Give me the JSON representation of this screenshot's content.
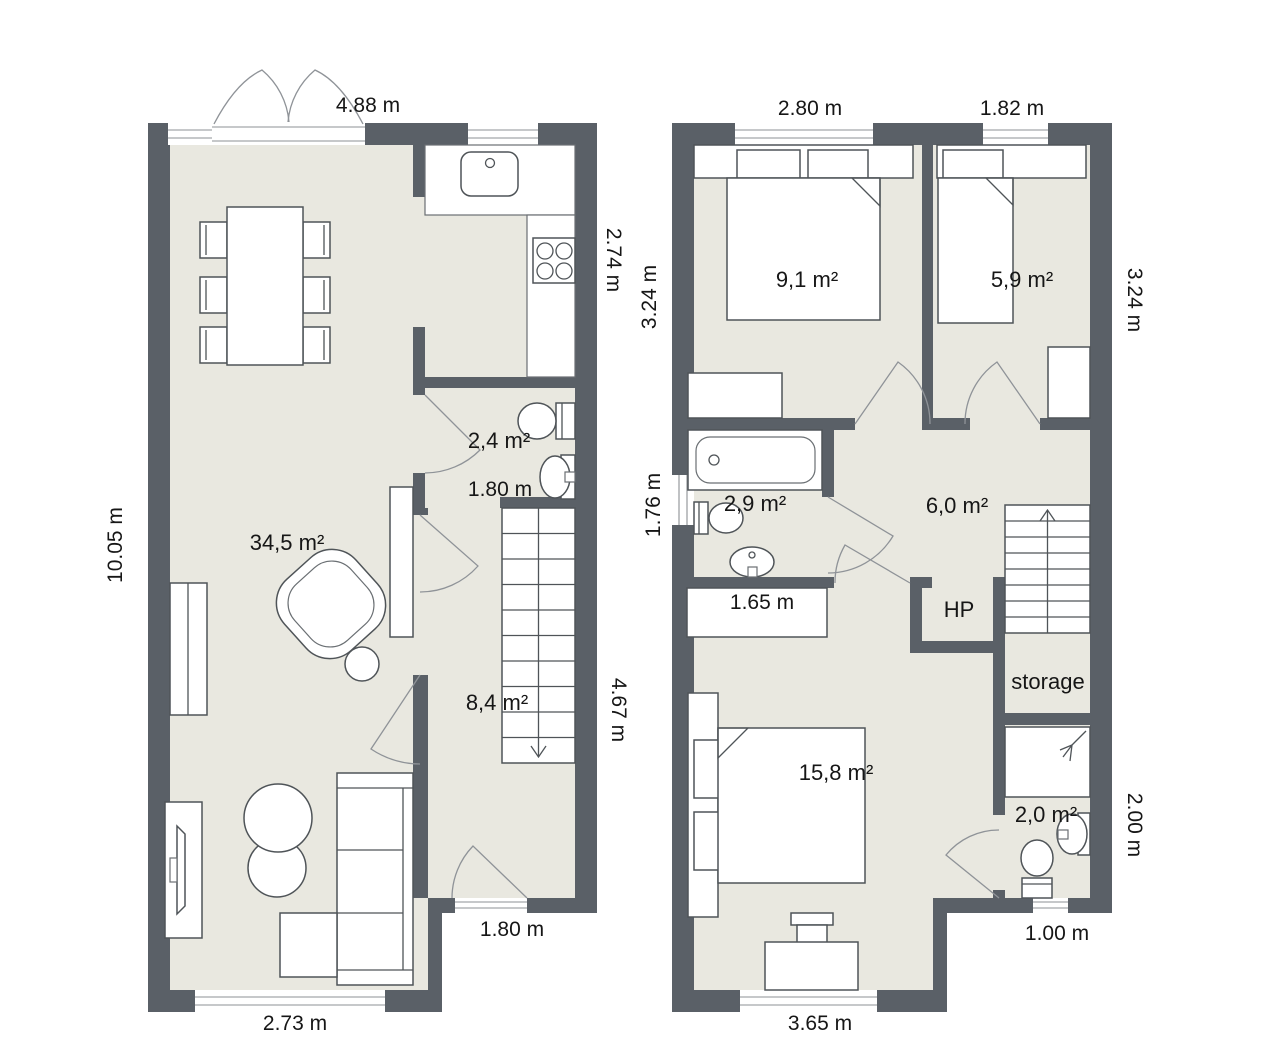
{
  "document_type": "floor-plan",
  "colors": {
    "wall": "#5a6067",
    "floor": "#e9e8e0",
    "furniture_fill": "#ffffff",
    "furniture_stroke": "#4f5458",
    "door_arc": "#8f9398",
    "text": "#161616"
  },
  "ground_floor": {
    "dims": {
      "top": "4.88 m",
      "right_upper": "2.74 m",
      "left": "10.05 m",
      "right_lower": "4.67 m",
      "bottom": "2.73 m",
      "entry_door": "1.80 m",
      "wc_width": "1.80 m"
    },
    "areas": {
      "living": "34,5 m²",
      "wc": "2,4 m²",
      "hall": "8,4 m²"
    }
  },
  "upper_floor": {
    "dims": {
      "top_left": "2.80 m",
      "top_right": "1.82 m",
      "left_upper": "3.24 m",
      "left_mid": "1.76 m",
      "right_upper": "3.24 m",
      "right_lower": "2.00 m",
      "bottom": "3.65 m",
      "bottom_right": "1.00 m",
      "closet": "1.65 m"
    },
    "areas": {
      "bedroom1": "9,1 m²",
      "bedroom2": "5,9 m²",
      "bathroom": "2,9 m²",
      "hall": "6,0 m²",
      "bedroom3": "15,8 m²",
      "wc": "2,0 m²"
    },
    "labels": {
      "heat_pump": "HP",
      "storage": "storage"
    }
  }
}
